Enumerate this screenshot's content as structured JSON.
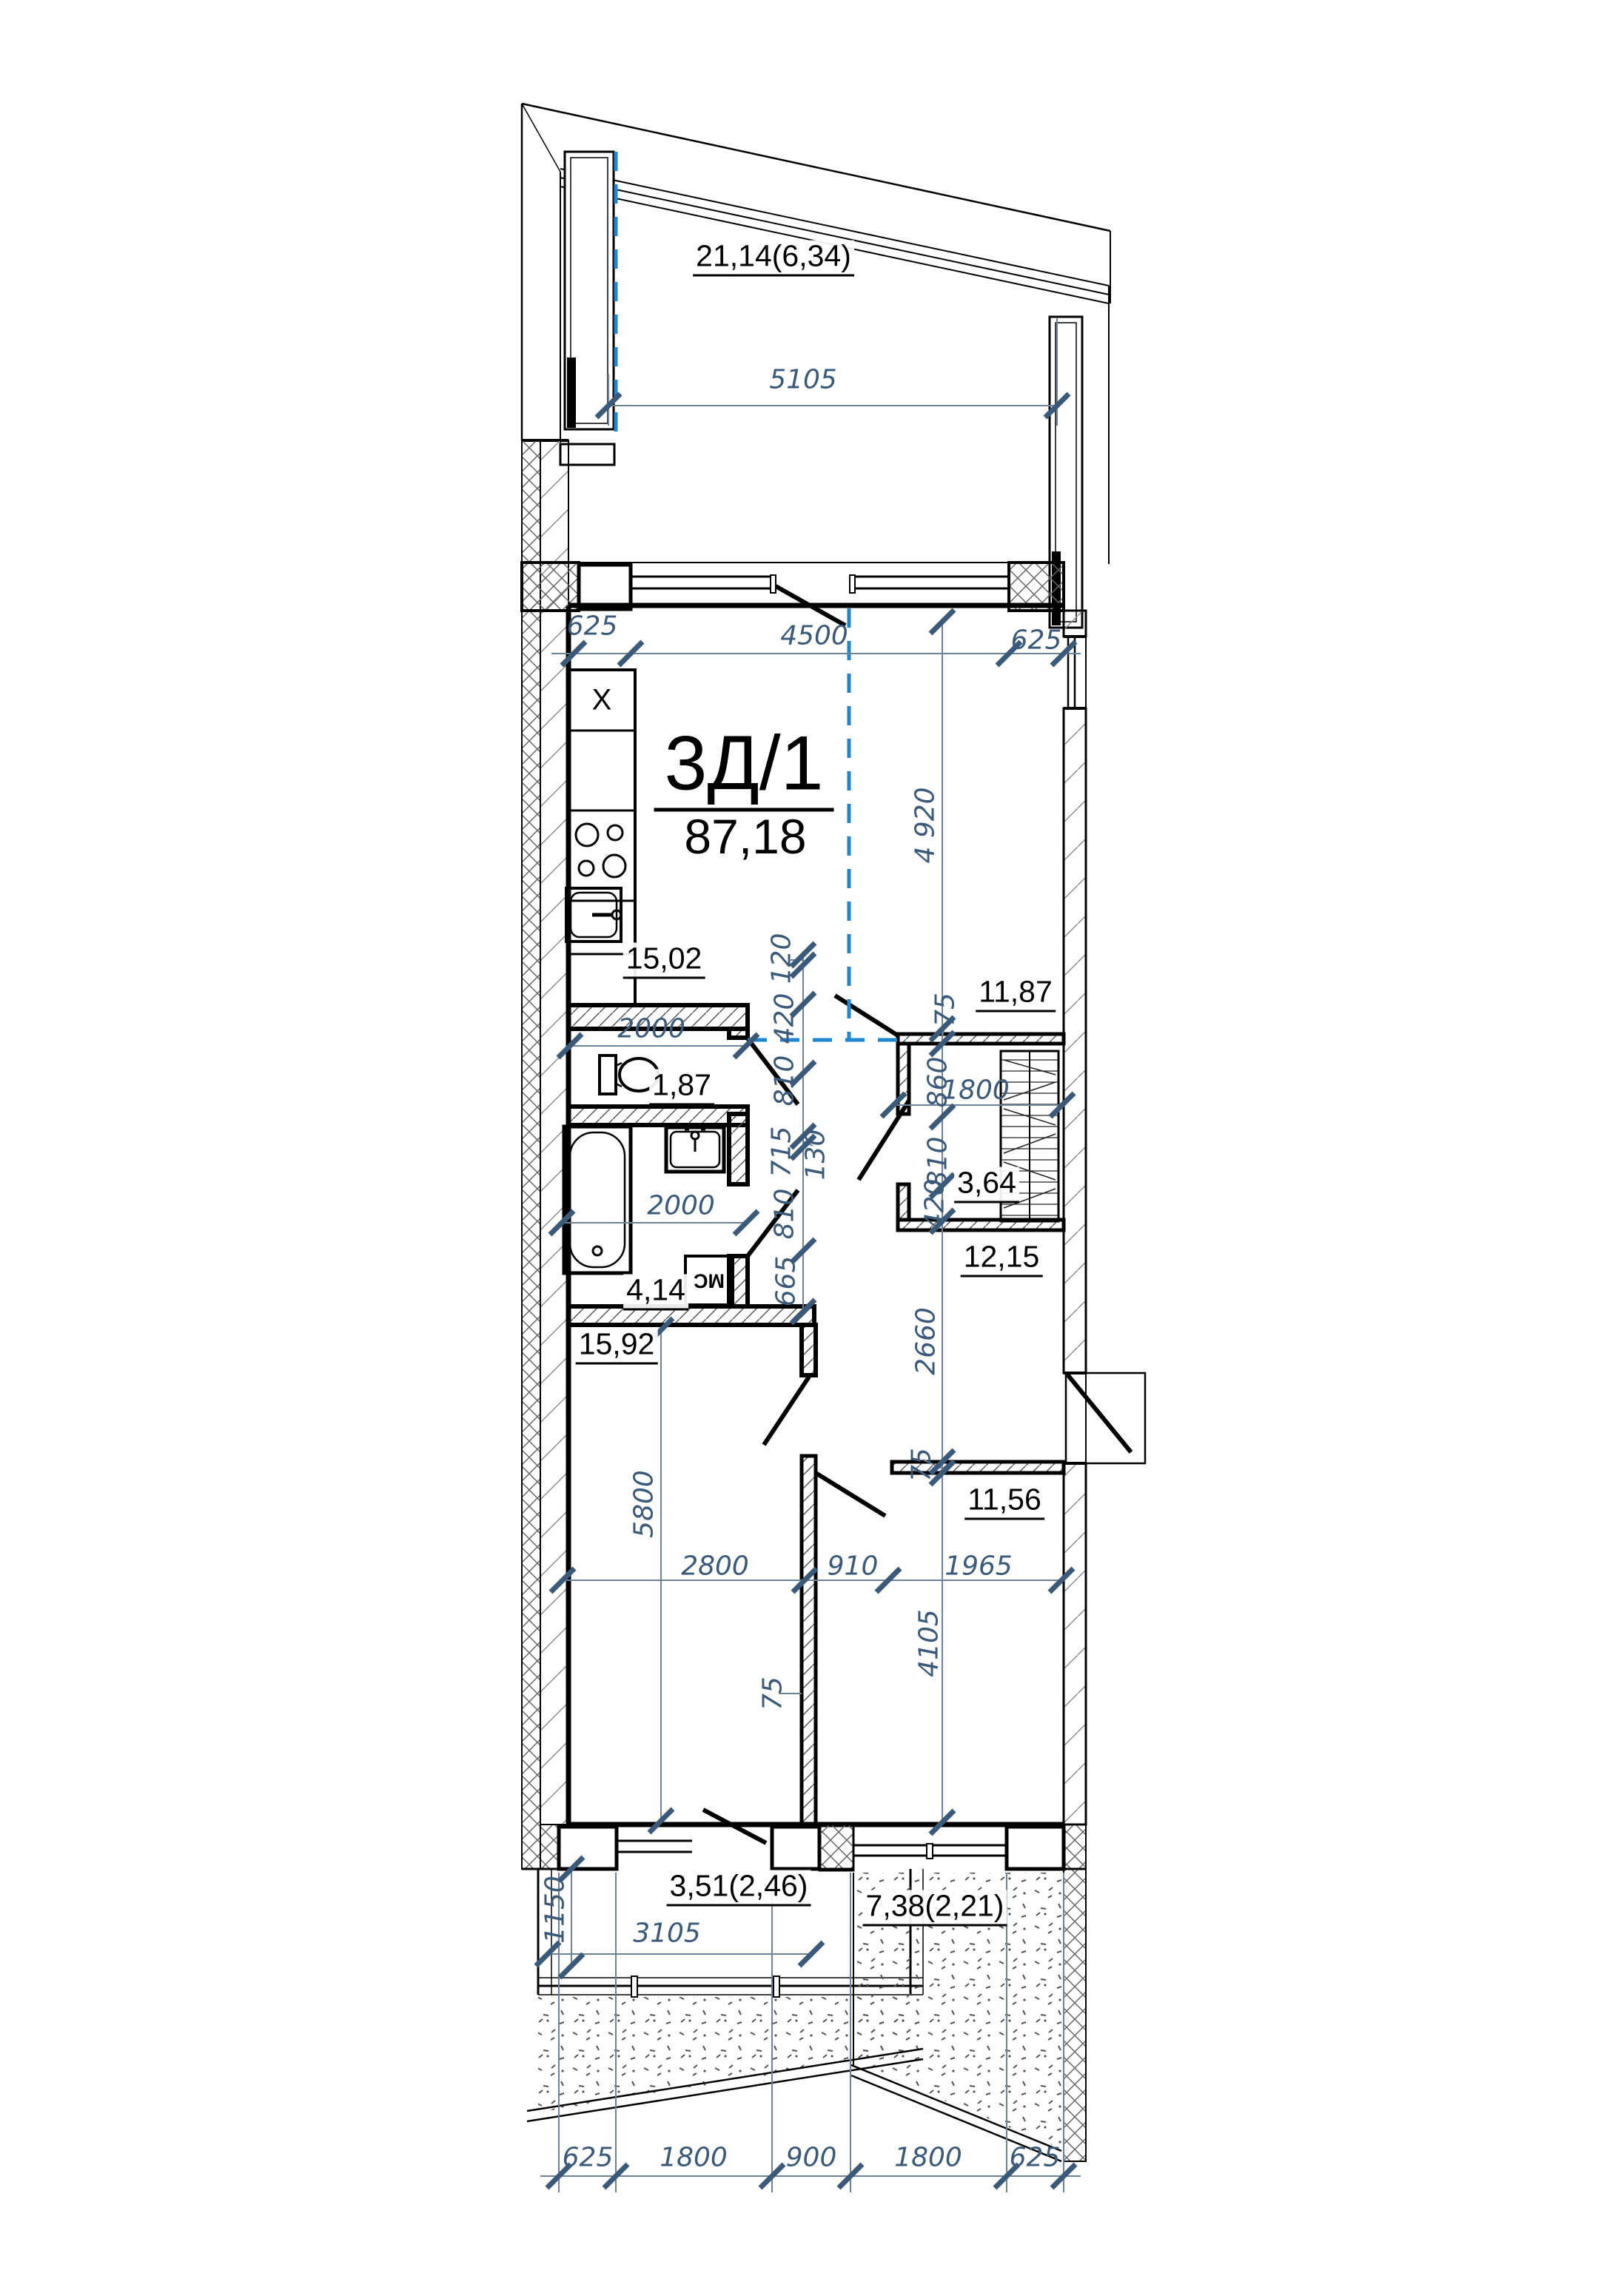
{
  "plan": {
    "unit_label": "3Д/1",
    "total_area": "87,18",
    "areas": {
      "balcony_top": "21,14(6,34)",
      "kitchen_living": "15,02",
      "bedroom_right": "11,87",
      "wc": "1,87",
      "closet": "3,64",
      "hall": "12,15",
      "bathroom": "4,14",
      "bedroom_left": "15,92",
      "bedroom_bottom": "11,56",
      "balcony_bottom": "3,51(2,46)",
      "terrace": "7,38(2,21)"
    },
    "symbols": {
      "vent_shaft": "X",
      "washing_machine": "МС"
    },
    "dims": {
      "balcony_width": "5105",
      "top_left": "625",
      "top_center": "4500",
      "top_right": "625",
      "living_height": "4 920",
      "c120": "120",
      "c420": "420",
      "c810a": "810",
      "c715": "715",
      "c130": "130",
      "c810b": "810",
      "c665": "665",
      "wall75_closet": "75",
      "closet860": "860",
      "closet1800": "1800",
      "closet810": "810",
      "closet420": "420",
      "wc_width": "2000",
      "bath_width": "2000",
      "hall_height": "2660",
      "wall75_hall": "75",
      "room_left_height": "5800",
      "room_left_width": "2800",
      "door910": "910",
      "room_bottom_width": "1965",
      "room_bottom_height": "4105",
      "wall75_rooms": "75",
      "balc_b_depth": "1150",
      "balc_b_width": "3105",
      "bot_625l": "625",
      "bot_1800l": "1800",
      "bot_900": "900",
      "bot_1800r": "1800",
      "bot_625r": "625"
    }
  }
}
